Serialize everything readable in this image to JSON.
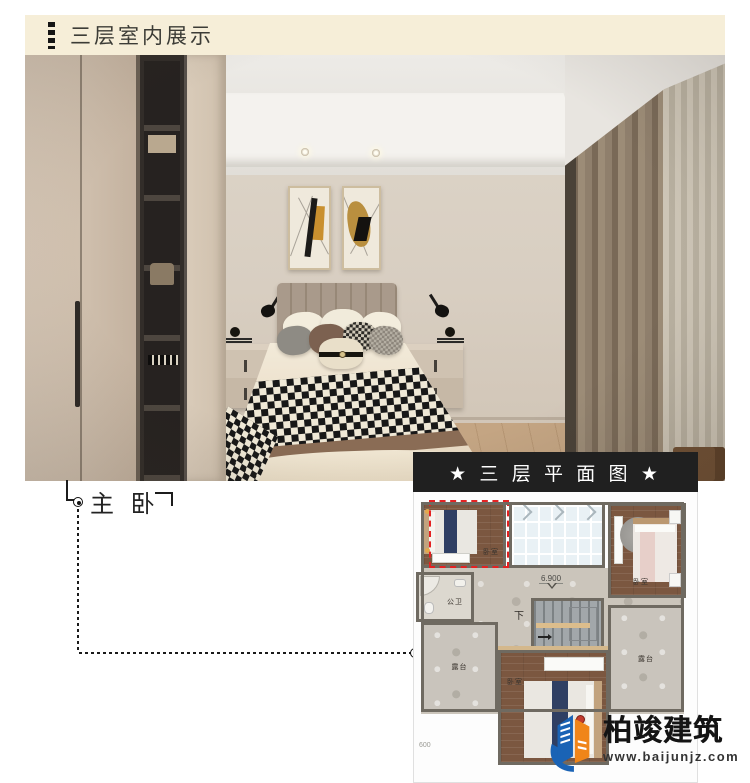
{
  "header": {
    "title": "三层室内展示"
  },
  "room_label": {
    "text": "主 卧"
  },
  "plan": {
    "title": "★ 三 层 平 面 图 ★",
    "labels": {
      "bedroom_top_left": "卧室",
      "bedroom_top_right": "卧室",
      "bedroom_bottom": "卧室",
      "bathroom": "公卫",
      "terrace_left": "露台",
      "terrace_right": "露台",
      "stairs_down": "下",
      "elevation": "6.900",
      "level_partial": "600"
    }
  },
  "logo": {
    "company": "柏竣建筑",
    "website": "www.baijunjz.com"
  },
  "colors": {
    "banner_bg": "#f6eed8",
    "plan_header_bg": "#202020",
    "highlight_dashed": "#e42222",
    "logo_blue": "#1a63b5",
    "logo_orange": "#f08519"
  }
}
